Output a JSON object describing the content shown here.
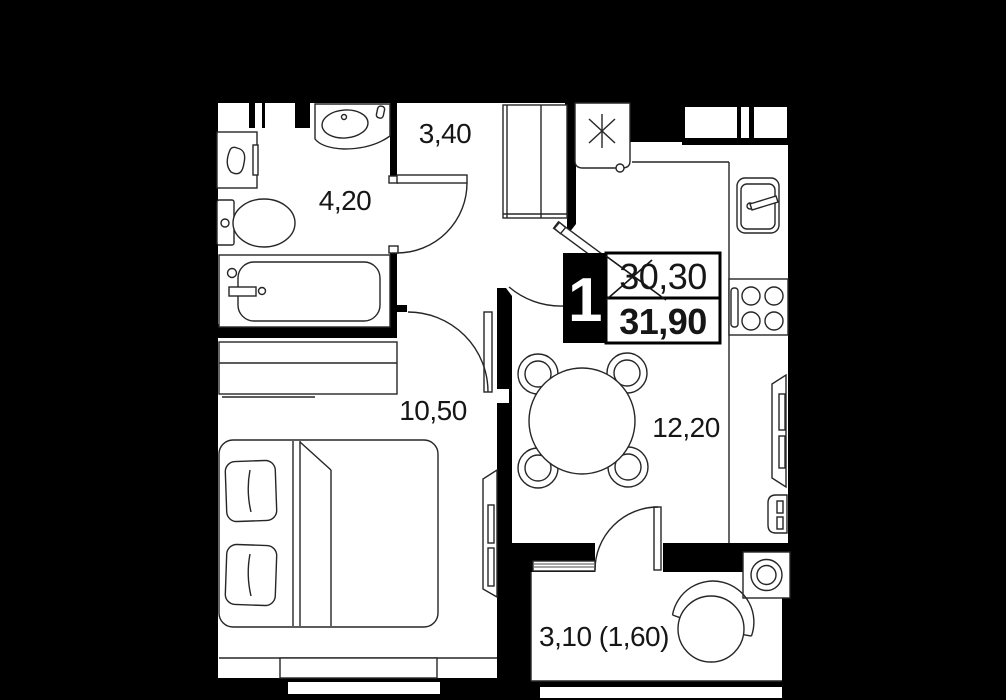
{
  "plan": {
    "badge": {
      "rooms": "1",
      "area_old": "30,30",
      "area_old_strikethrough": true,
      "area_new": "31,90"
    },
    "rooms": [
      {
        "name": "hallway",
        "area": "3,40"
      },
      {
        "name": "bathroom",
        "area": "4,20"
      },
      {
        "name": "bedroom",
        "area": "10,50"
      },
      {
        "name": "kitchen-living-room",
        "area": "12,20"
      },
      {
        "name": "balcony",
        "area": "3,10 (1,60)"
      }
    ],
    "colors": {
      "background": "#000000",
      "floor": "#ffffff",
      "line": "#262626"
    },
    "furniture": [
      "vanity-sink",
      "towel-cabinet",
      "toilet",
      "bathtub",
      "wardrobe",
      "appliance-niche-star",
      "kitchen-sink",
      "stove",
      "kitchen-counter",
      "dining-table",
      "chair",
      "bed",
      "dresser",
      "tv-bedroom",
      "tv-living",
      "radiator",
      "washing-machine",
      "balcony-chair",
      "entry-door",
      "bathroom-door",
      "bedroom-door",
      "kitchen-door",
      "balcony-door"
    ]
  }
}
